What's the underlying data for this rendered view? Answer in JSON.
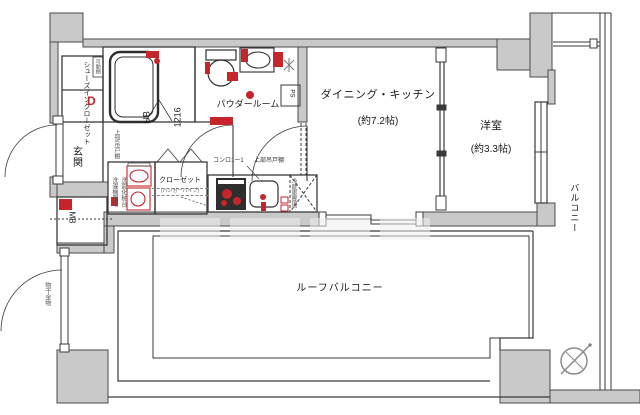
{
  "plan": {
    "title": "1DK apartment floor plan with roof balcony",
    "rooms": {
      "dining_kitchen": {
        "name": "ダイニング・キッチン",
        "area": "(約7.2帖)"
      },
      "western_room": {
        "name": "洋室",
        "area": "(約3.3帖)"
      },
      "roof_balcony": {
        "name": "ルーフバルコニー"
      },
      "balcony": {
        "name": "バルコニー"
      },
      "entrance": {
        "name": "玄関"
      },
      "shoes_in_closet": {
        "name": "シューズインクローゼット"
      },
      "unit_bath": {
        "line1": "UB",
        "line2": "1216"
      },
      "powder_room": {
        "name": "パウダールーム"
      },
      "closet": {
        "name": "クローゼット",
        "note": "(ハンガーパイプ)"
      },
      "meter_box": {
        "name": "MB"
      },
      "pipe_space": {
        "name": "PS"
      }
    },
    "notes": {
      "fridge": "冷蔵庫置場",
      "laundry": "洗濯機置場",
      "vanity": "洗面化粧台",
      "upper_cabinet": "上部吊戸棚",
      "kitchen_code": "コンロ1ー1",
      "kitchen_cabinet": "上部吊戸棚",
      "shelf": "可動棚",
      "door_mark": "D",
      "pole": "物干金物"
    },
    "colors": {
      "wall_fill": "#c9c9c9",
      "line": "#3a3a3a",
      "accent_red": "#c5252b",
      "compass_gray": "#8a8a8a"
    }
  }
}
